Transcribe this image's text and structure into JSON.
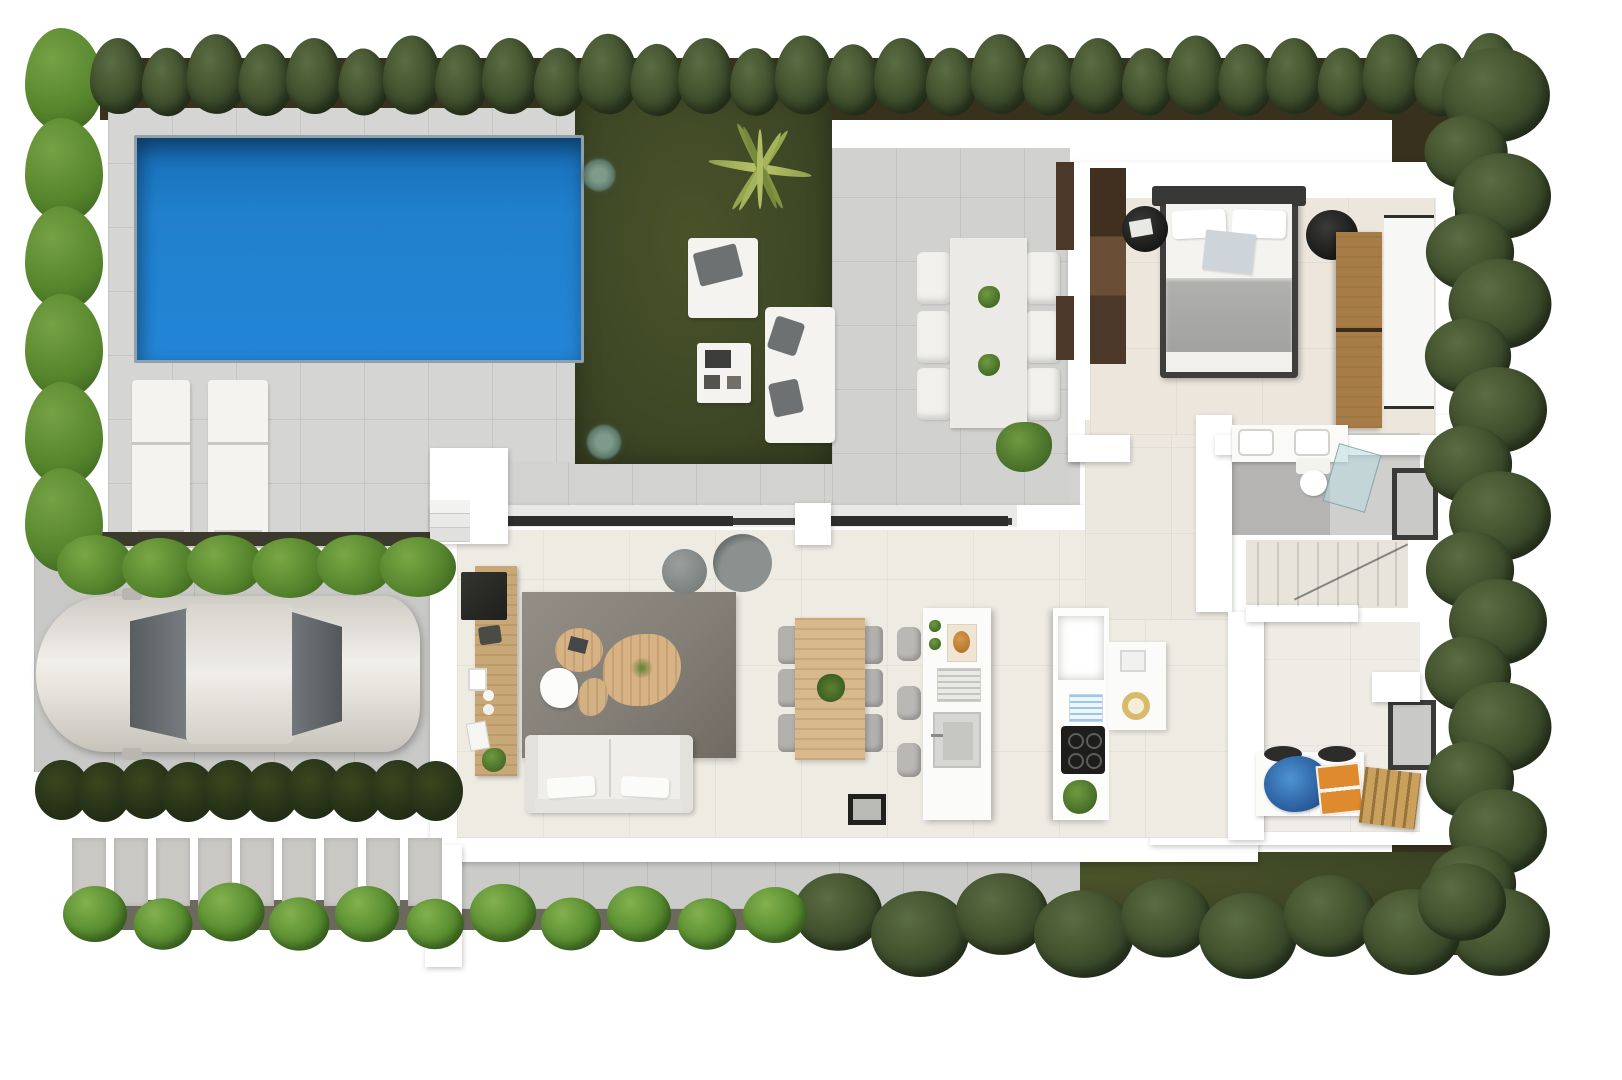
{
  "title": "Top-down 3D floor plan render — single-storey villa with pool, garden and driveway",
  "scene": {
    "type": "floor-plan-3d",
    "view": "top-down",
    "visible_text": "none"
  },
  "palette": {
    "background": "#ffffff",
    "pool_water": "#2079c8",
    "pool_shadow": "#135e9f",
    "patio_tile": "#d5d5d3",
    "interior_floor": "#eeebe3",
    "bathroom_floor": "#b5b4b2",
    "garden_grass": "#3f4826",
    "mulch_soil": "#37311d",
    "hedge_green": "#55842c",
    "tree_green": "#43532f",
    "wall_white": "#ffffff",
    "rug_gray": "#8a8680",
    "wood_light": "#d8b98c",
    "wardrobe_wood": "#a87c46",
    "duvet_gray": "#a8a8a6",
    "car_body": "#e9e7e1",
    "glass_rail": "#3a3a38",
    "laundry_blue": "#3d7ec2",
    "box_orange": "#e08a2e"
  },
  "rooms": {
    "living": {
      "label": "Living room",
      "furniture": [
        "two-seat sofa",
        "gray rug",
        "organic coffee tables",
        "TV sideboard",
        "two gray poufs"
      ]
    },
    "dining": {
      "label": "Dining area",
      "furniture": [
        "wooden table",
        "6 gray chairs",
        "plant centerpiece"
      ]
    },
    "kitchen": {
      "label": "Kitchen",
      "furniture": [
        "island with sink",
        "3 bar stools",
        "tall unit with cooktop and fridge",
        "side counter with bowl"
      ]
    },
    "bedroom": {
      "label": "Bedroom",
      "furniture": [
        "double bed with gray duvet",
        "2 round nightstands",
        "wood wardrobe",
        "built-in closet"
      ]
    },
    "bathroom": {
      "label": "Bathroom",
      "furniture": [
        "double vanity",
        "toilet",
        "glass shower"
      ]
    },
    "utility": {
      "label": "Utility room",
      "furniture": [
        "washer",
        "dryer",
        "blue laundry pile",
        "orange box",
        "wooden crate"
      ]
    },
    "stairs": {
      "label": "Staircase"
    },
    "hall": {
      "label": "Hallway"
    }
  },
  "outdoor": {
    "pool": {
      "label": "Swimming pool"
    },
    "pool_terrace": {
      "label": "Pool terrace",
      "furniture": [
        "2 sun loungers"
      ]
    },
    "garden": {
      "label": "Garden lawn",
      "furniture": [
        "lounge chair",
        "magazine side table",
        "outdoor sofa",
        "palm",
        "2 agaves"
      ]
    },
    "terrace_dining": {
      "label": "Outdoor dining terrace",
      "furniture": [
        "white table",
        "6 chairs",
        "2 table plants",
        "corner shrub"
      ]
    },
    "driveway": {
      "label": "Driveway",
      "furniture": [
        "parked car"
      ]
    },
    "path": {
      "label": "Paved walkway"
    },
    "entry": {
      "label": "Entrance porch with steps"
    }
  },
  "vegetation": {
    "top_trees": [
      {
        "x": 118,
        "y": 76,
        "s": 1
      },
      {
        "x": 167,
        "y": 82,
        "s": 0.9
      },
      {
        "x": 216,
        "y": 74,
        "s": 1.05
      },
      {
        "x": 265,
        "y": 80,
        "s": 0.95
      },
      {
        "x": 314,
        "y": 76,
        "s": 1
      },
      {
        "x": 363,
        "y": 82,
        "s": 0.88
      },
      {
        "x": 412,
        "y": 75,
        "s": 1.04
      },
      {
        "x": 461,
        "y": 80,
        "s": 0.93
      },
      {
        "x": 510,
        "y": 76,
        "s": 1
      },
      {
        "x": 559,
        "y": 82,
        "s": 0.9
      },
      {
        "x": 608,
        "y": 74,
        "s": 1.06
      },
      {
        "x": 657,
        "y": 80,
        "s": 0.95
      },
      {
        "x": 706,
        "y": 76,
        "s": 1
      },
      {
        "x": 755,
        "y": 82,
        "s": 0.89
      },
      {
        "x": 804,
        "y": 75,
        "s": 1.04
      },
      {
        "x": 853,
        "y": 80,
        "s": 0.94
      },
      {
        "x": 902,
        "y": 76,
        "s": 1
      },
      {
        "x": 951,
        "y": 82,
        "s": 0.9
      },
      {
        "x": 1000,
        "y": 74,
        "s": 1.05
      },
      {
        "x": 1049,
        "y": 80,
        "s": 0.94
      },
      {
        "x": 1098,
        "y": 76,
        "s": 1
      },
      {
        "x": 1147,
        "y": 82,
        "s": 0.89
      },
      {
        "x": 1196,
        "y": 75,
        "s": 1.04
      },
      {
        "x": 1245,
        "y": 80,
        "s": 0.95
      },
      {
        "x": 1294,
        "y": 76,
        "s": 1
      },
      {
        "x": 1343,
        "y": 82,
        "s": 0.9
      },
      {
        "x": 1392,
        "y": 74,
        "s": 1.05
      },
      {
        "x": 1441,
        "y": 80,
        "s": 0.96
      },
      {
        "x": 1490,
        "y": 74,
        "s": 1.08
      }
    ],
    "right_trees": [
      {
        "x": 1496,
        "y": 95,
        "s": 1.1
      },
      {
        "x": 1466,
        "y": 152,
        "s": 0.85
      },
      {
        "x": 1502,
        "y": 196,
        "s": 1
      },
      {
        "x": 1470,
        "y": 252,
        "s": 0.9
      },
      {
        "x": 1500,
        "y": 304,
        "s": 1.05
      },
      {
        "x": 1468,
        "y": 356,
        "s": 0.88
      },
      {
        "x": 1498,
        "y": 410,
        "s": 1
      },
      {
        "x": 1468,
        "y": 464,
        "s": 0.9
      },
      {
        "x": 1500,
        "y": 516,
        "s": 1.04
      },
      {
        "x": 1470,
        "y": 570,
        "s": 0.9
      },
      {
        "x": 1498,
        "y": 622,
        "s": 1
      },
      {
        "x": 1468,
        "y": 674,
        "s": 0.88
      },
      {
        "x": 1500,
        "y": 727,
        "s": 1.05
      },
      {
        "x": 1470,
        "y": 780,
        "s": 0.9
      },
      {
        "x": 1498,
        "y": 832,
        "s": 1
      },
      {
        "x": 1472,
        "y": 884,
        "s": 0.9
      },
      {
        "x": 1500,
        "y": 932,
        "s": 1.02
      }
    ],
    "corner_trees": [
      {
        "x": 838,
        "y": 912,
        "s": 0.9
      },
      {
        "x": 920,
        "y": 934,
        "s": 1
      },
      {
        "x": 1002,
        "y": 914,
        "s": 0.95
      },
      {
        "x": 1084,
        "y": 934,
        "s": 1.02
      },
      {
        "x": 1166,
        "y": 918,
        "s": 0.92
      },
      {
        "x": 1248,
        "y": 936,
        "s": 1
      },
      {
        "x": 1330,
        "y": 916,
        "s": 0.95
      },
      {
        "x": 1412,
        "y": 932,
        "s": 1
      },
      {
        "x": 1462,
        "y": 902,
        "s": 0.9
      }
    ],
    "front_bushes": [
      {
        "x": 95,
        "y": 914,
        "s": 1
      },
      {
        "x": 163,
        "y": 924,
        "s": 0.92
      },
      {
        "x": 231,
        "y": 912,
        "s": 1.05
      },
      {
        "x": 299,
        "y": 924,
        "s": 0.95
      },
      {
        "x": 367,
        "y": 914,
        "s": 1
      },
      {
        "x": 435,
        "y": 924,
        "s": 0.9
      },
      {
        "x": 503,
        "y": 913,
        "s": 1.04
      },
      {
        "x": 571,
        "y": 924,
        "s": 0.94
      },
      {
        "x": 639,
        "y": 914,
        "s": 1
      },
      {
        "x": 707,
        "y": 924,
        "s": 0.92
      },
      {
        "x": 775,
        "y": 915,
        "s": 1
      }
    ],
    "left_hedge": [
      {
        "x": 64,
        "y": 80
      },
      {
        "x": 64,
        "y": 170
      },
      {
        "x": 64,
        "y": 258
      },
      {
        "x": 64,
        "y": 346
      },
      {
        "x": 64,
        "y": 434
      },
      {
        "x": 64,
        "y": 520
      }
    ],
    "front_hedge": [
      {
        "x": 95,
        "y": 565
      },
      {
        "x": 160,
        "y": 568
      },
      {
        "x": 225,
        "y": 565
      },
      {
        "x": 290,
        "y": 568
      },
      {
        "x": 355,
        "y": 565
      },
      {
        "x": 418,
        "y": 567
      }
    ],
    "dark_hedge": [
      {
        "x": 62,
        "y": 790
      },
      {
        "x": 104,
        "y": 792
      },
      {
        "x": 146,
        "y": 789
      },
      {
        "x": 188,
        "y": 792
      },
      {
        "x": 230,
        "y": 790
      },
      {
        "x": 272,
        "y": 792
      },
      {
        "x": 314,
        "y": 789
      },
      {
        "x": 356,
        "y": 792
      },
      {
        "x": 398,
        "y": 790
      },
      {
        "x": 436,
        "y": 791
      }
    ],
    "walk_slabs": [
      {
        "x": 89,
        "y": 872
      },
      {
        "x": 131,
        "y": 872
      },
      {
        "x": 173,
        "y": 872
      },
      {
        "x": 215,
        "y": 872
      },
      {
        "x": 257,
        "y": 872
      },
      {
        "x": 299,
        "y": 872
      },
      {
        "x": 341,
        "y": 872
      },
      {
        "x": 383,
        "y": 872
      },
      {
        "x": 425,
        "y": 872
      }
    ]
  },
  "seating": {
    "outdoor_chairs": [
      {
        "x": 934,
        "y": 278
      },
      {
        "x": 934,
        "y": 337
      },
      {
        "x": 934,
        "y": 394
      },
      {
        "x": 1043,
        "y": 278
      },
      {
        "x": 1043,
        "y": 337
      },
      {
        "x": 1043,
        "y": 394
      }
    ],
    "dining_chairs": [
      {
        "x": 789,
        "y": 645
      },
      {
        "x": 789,
        "y": 688
      },
      {
        "x": 789,
        "y": 733
      },
      {
        "x": 872,
        "y": 645
      },
      {
        "x": 872,
        "y": 688
      },
      {
        "x": 872,
        "y": 733
      }
    ],
    "island_stools": [
      {
        "x": 909,
        "y": 644
      },
      {
        "x": 909,
        "y": 703
      },
      {
        "x": 909,
        "y": 760
      }
    ],
    "stair_treads": [
      {
        "x": 1258,
        "y": 574
      },
      {
        "x": 1278,
        "y": 574
      },
      {
        "x": 1298,
        "y": 574
      },
      {
        "x": 1318,
        "y": 574
      },
      {
        "x": 1338,
        "y": 574
      },
      {
        "x": 1358,
        "y": 574
      },
      {
        "x": 1378,
        "y": 574
      },
      {
        "x": 1396,
        "y": 574
      }
    ]
  }
}
